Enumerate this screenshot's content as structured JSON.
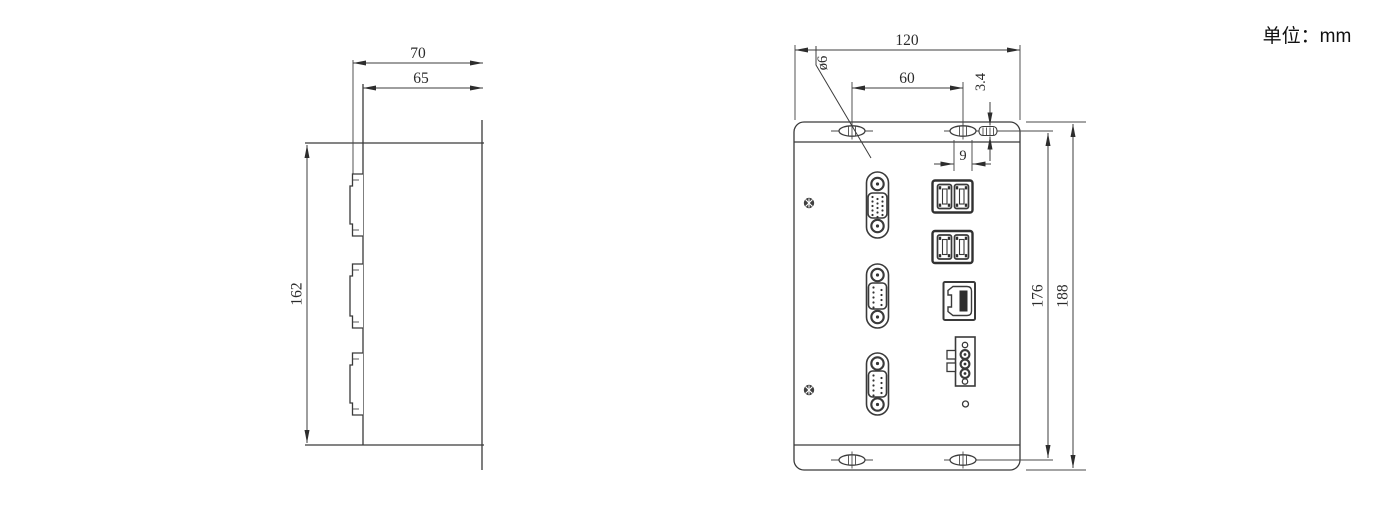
{
  "meta": {
    "drawing_type": "mechanical-dimension-drawing",
    "units_label": "单位：mm",
    "line_color": "#3a3a3a"
  },
  "side_view": {
    "label": "side view",
    "dims": {
      "depth_total": "70",
      "depth_body": "65",
      "height_body": "162"
    },
    "components": [
      "db-connector-profile",
      "db-connector-profile",
      "db-connector-profile"
    ]
  },
  "front_view": {
    "label": "front view",
    "dims": {
      "width": "120",
      "slot_pitch_x": "60",
      "slot_length": "9",
      "slot_width": "3.4",
      "hole_diameter": "ø6",
      "slot_pitch_y": "176",
      "height_total": "188"
    },
    "components": [
      "mounting-slot",
      "mounting-slot",
      "mounting-slot",
      "mounting-slot",
      "panel-screw",
      "panel-screw",
      "vga-port",
      "usb-ports",
      "usb-ports",
      "db9-port",
      "lan-port",
      "db9-port",
      "power-terminal",
      "led-indicator"
    ]
  }
}
